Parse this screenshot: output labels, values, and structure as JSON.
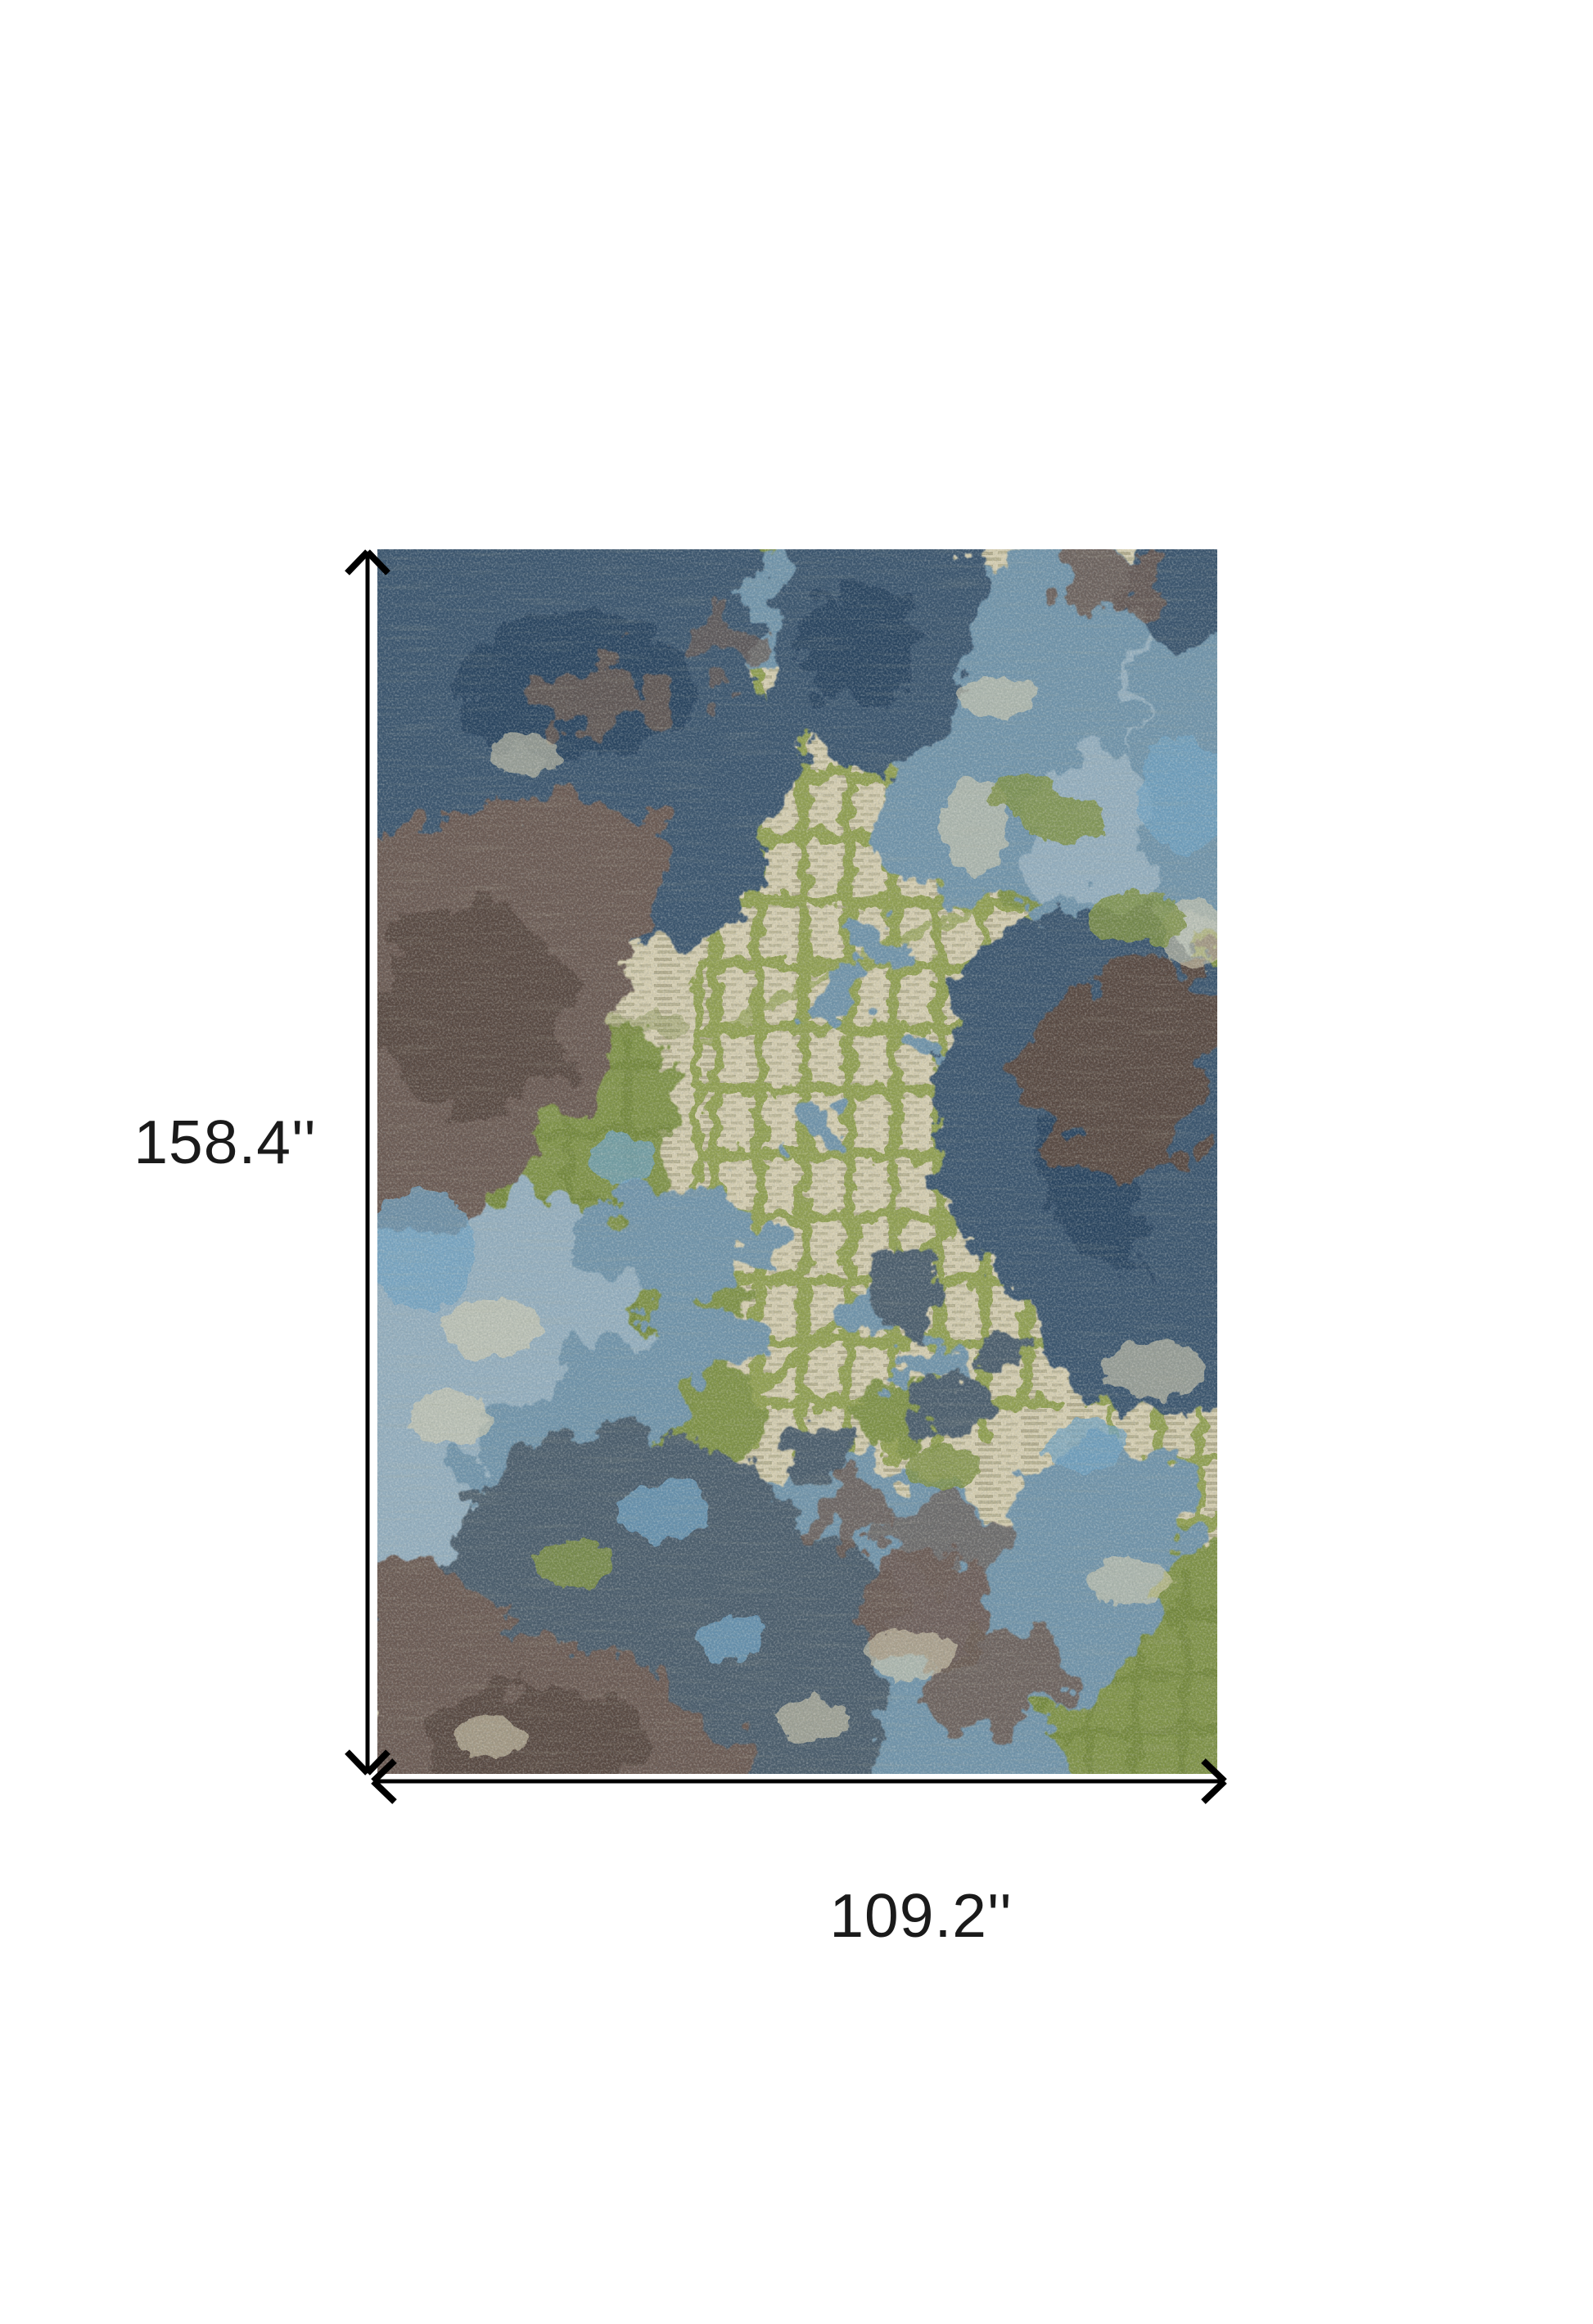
{
  "page": {
    "type": "product dimension image",
    "background": "#ffffff"
  },
  "product": {
    "name": "abstract-area-rug",
    "description": "Abstract area rug with green sketched grid over beige, splashed with steel blue, navy and brown patches"
  },
  "dimensions": {
    "height_label": "158.4''",
    "width_label": "109.2''"
  },
  "palette": {
    "page_bg": "#ffffff",
    "label_text": "#1a1a1a",
    "arrow": "#000000",
    "beige": "#d3ccb0",
    "beige_dark": "#938f6e",
    "olive": "#8d9c4e",
    "olive_deep": "#6f8437",
    "green": "#7e9147",
    "blue": "#7093a9",
    "blue_light": "#93adbd",
    "blue_bright": "#6fa0c0",
    "navy": "#3a556e",
    "navy_dark": "#2b4460",
    "slate": "#4c5d6c",
    "brown": "#6b5a52",
    "brown_dark": "#594a43"
  }
}
